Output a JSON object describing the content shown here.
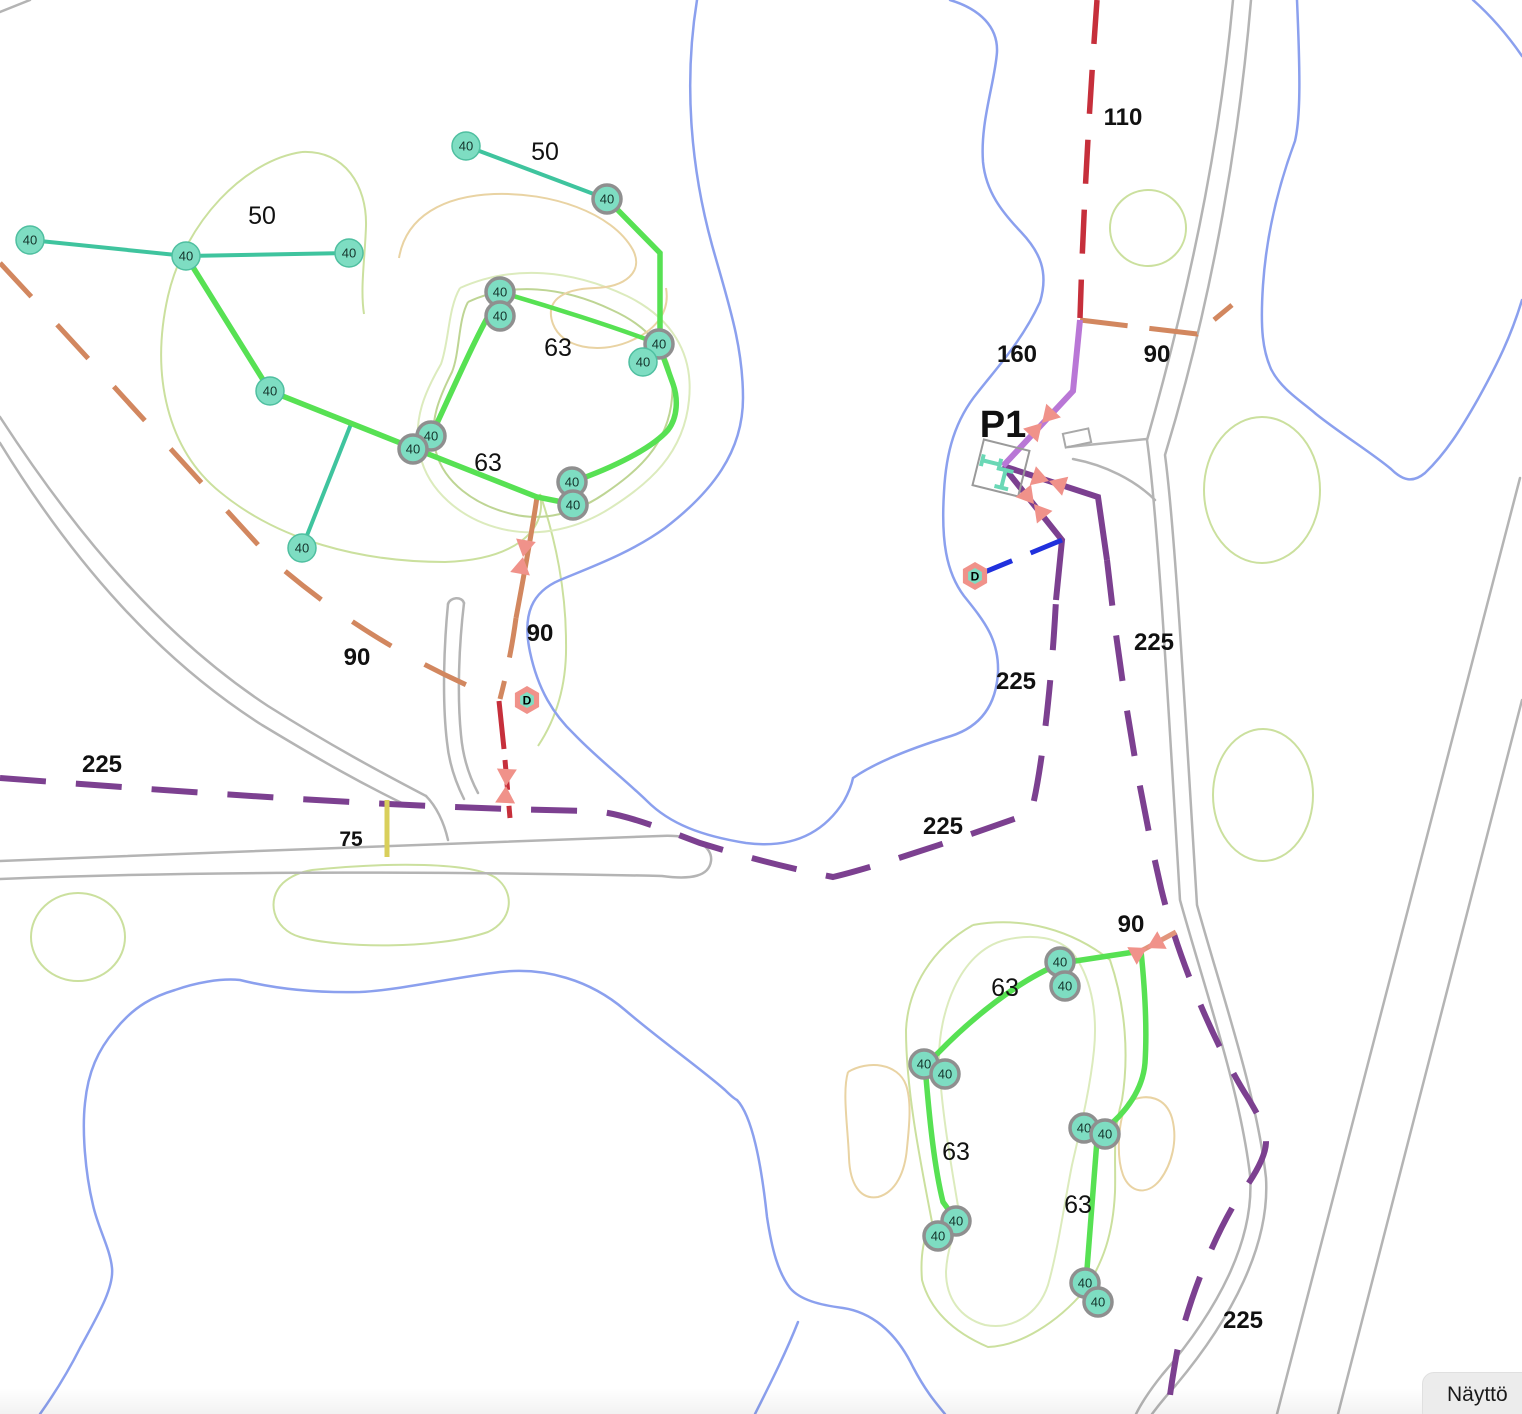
{
  "app": {
    "display_button_label": "Näyttö"
  },
  "map": {
    "width": 1522,
    "height": 1414,
    "node_label": "40",
    "node_radius": 14,
    "colors": {
      "contour_green": "#cbe09e",
      "contour_light": "#dcebbd",
      "contour_olive": "#bed594",
      "contour_tan": "#e9d3a3",
      "water": "#8ba0ee",
      "road": "#b4b4b4",
      "pipe_teal": "#3fc49e",
      "pipe_green": "#57e153",
      "pipe_orange": "#d2875f",
      "pipe_red": "#c62f3b",
      "pipe_purple": "#7c4090",
      "pipe_orchid": "#b977d6",
      "pipe_yellow": "#d9cf5b",
      "pipe_blue": "#2030dd",
      "pipe_salmon": "#e2957c",
      "node_fill": "#7eddc2",
      "node_edge": "#4fbfa0",
      "node_ring": "#8f8f8f",
      "valve": "#f0928a",
      "marker_inner": "#7eddc2",
      "station_outline": "#9a9a9a",
      "station_symbol": "#6ad8b6",
      "building": "#a9a9a9",
      "label": "#111111"
    },
    "contours": [
      {
        "name": "contour-upper-left-outer",
        "color": "contour_green",
        "d": "M302,152 C245,160 185,222 168,296 C150,376 168,450 220,492 C278,540 360,562 445,562 C512,560 548,532 540,494"
      },
      {
        "name": "contour-upper-left-outer-south",
        "color": "contour_green",
        "d": "M540,494 C556,540 566,592 566,642 C567,682 558,716 538,746"
      },
      {
        "name": "contour-upper-left-oval-east",
        "color": "contour_green",
        "d": "M302,152 C345,150 367,186 366,226 C365,258 360,288 364,314"
      },
      {
        "name": "contour-upper-ring-inner",
        "color": "contour_olive",
        "d": "M468,302 C510,282 562,286 612,310 C652,328 676,358 672,398 C668,446 636,472 604,494 C576,513 544,522 512,514 C474,505 444,482 436,452 C428,422 440,396 452,372 C460,352 458,320 468,302"
      },
      {
        "name": "contour-upper-ring-outer",
        "color": "contour_light",
        "d": "M460,288 C514,264 572,270 627,296 C670,317 694,352 689,400 C684,454 648,484 612,507 C580,528 540,538 502,529 C460,519 428,490 420,455 C412,419 426,390 441,364 C449,342 448,308 460,288"
      },
      {
        "name": "contour-upper-tan",
        "color": "contour_tan",
        "d": "M399,258 C406,216 444,196 494,194 C550,192 612,212 633,250 C644,272 625,287 595,288 C560,289 545,302 553,324 C562,348 598,354 628,342 C658,330 670,310 666,288"
      },
      {
        "name": "contour-circle-topright",
        "color": "contour_green",
        "ellipse": [
          1148,
          228,
          38,
          38
        ]
      },
      {
        "name": "contour-oval-east-1",
        "color": "contour_green",
        "ellipse": [
          1262,
          490,
          58,
          73
        ]
      },
      {
        "name": "contour-oval-east-2",
        "color": "contour_green",
        "ellipse": [
          1263,
          795,
          50,
          66
        ]
      },
      {
        "name": "contour-circle-southwest",
        "color": "contour_green",
        "ellipse": [
          78,
          937,
          47,
          44
        ]
      },
      {
        "name": "contour-blob-south",
        "color": "contour_green",
        "d": "M312,870 C390,862 472,862 496,878 C516,893 512,921 488,932 C436,950 338,948 300,937 C272,929 266,899 283,883 C291,876 300,872 312,870"
      },
      {
        "name": "contour-lower-outer",
        "color": "contour_green",
        "d": "M973,925 C1023,916 1072,930 1110,960 C1126,1007 1129,1057 1122,1100 C1112,1135 1116,1160 1115,1192 C1113,1235 1103,1262 1085,1290 C1057,1323 1020,1346 988,1347 C953,1332 930,1310 922,1280 C920,1255 924,1235 932,1222 C920,1160 906,1090 906,1030 C908,988 932,948 973,925"
      },
      {
        "name": "contour-lower-inner",
        "color": "contour_light",
        "d": "M1005,940 C1035,933 1058,938 1072,952 C1090,975 1098,1010 1094,1050 C1090,1090 1080,1130 1072,1165 C1064,1205 1058,1250 1048,1285 C1038,1315 1012,1330 985,1325 C960,1318 946,1298 946,1272 C947,1250 954,1233 960,1218 C952,1170 941,1110 939,1058 C939,1015 958,952 1005,940"
      },
      {
        "name": "contour-tan-lower-left",
        "color": "contour_tan",
        "d": "M848,1072 C868,1060 898,1063 906,1085 C912,1102 909,1128 907,1148 C905,1172 896,1192 878,1197 C860,1200 850,1184 849,1158 C848,1128 842,1092 848,1072"
      },
      {
        "name": "contour-tan-lower-right",
        "color": "contour_tan",
        "d": "M1128,1102 C1148,1092 1166,1098 1172,1118 C1178,1140 1172,1164 1160,1180 C1147,1196 1130,1193 1123,1175 C1116,1156 1118,1118 1128,1102"
      }
    ],
    "water": [
      {
        "name": "water-lake-middle",
        "d": "M697,0 C684,80 690,165 712,245 C728,302 743,345 743,398 C743,452 712,492 665,528 C632,552 594,566 560,580 C532,592 522,614 530,652 C538,690 554,715 574,734 C597,758 622,777 647,801 C670,824 702,836 746,843 C784,848 820,839 844,801 C850,790 852,783 853,778 C876,762 912,748 951,736 C976,728 996,710 998,672 C999,640 985,622 964,596 C946,572 941,540 944,492 C946,452 955,420 978,392 C996,369 1022,341 1040,302 C1049,272 1040,252 1021,232 C1002,212 986,192 983,162 C980,122 995,82 997,52 C998,27 980,9 950,0"
      },
      {
        "name": "water-lake-northeast",
        "d": "M1297,0 C1300,70 1301,115 1295,141 C1282,176 1267,226 1263,285 C1260,330 1263,351 1271,369 C1281,389 1301,401 1316,414 C1341,434 1372,453 1391,469 C1403,481 1413,483 1425,473 C1446,453 1461,429 1478,399 C1498,363 1511,336 1522,300"
      },
      {
        "name": "water-lake-northeast-corner",
        "d": "M1473,0 C1490,15 1506,33 1522,56"
      },
      {
        "name": "water-stream-south",
        "d": "M40,1414 C57,1390 70,1368 80,1348 C98,1315 114,1288 112,1268 C110,1248 98,1228 93,1205 C85,1172 82,1130 85,1103 C88,1072 98,1050 115,1030 C135,1005 155,996 175,990 C195,983 220,978 240,980 C280,990 320,993 360,992 C400,990 450,978 500,972 C545,967 590,980 625,1010 C660,1040 700,1068 725,1090 C733,1098 737,1100 737,1100 C753,1117 762,1170 767,1217 C772,1250 778,1272 790,1288 C800,1300 820,1305 843,1308 C870,1312 895,1330 913,1367 C925,1390 935,1402 945,1414"
      },
      {
        "name": "water-stream-fork",
        "d": "M798,1322 C785,1355 768,1388 755,1414"
      }
    ],
    "roads": [
      {
        "name": "road-ne-left",
        "d": "M1233,0 C1222,120 1198,260 1147,440 C1158,520 1168,700 1180,900 C1205,990 1240,1090 1250,1175 C1255,1240 1218,1310 1162,1375 C1150,1390 1142,1402 1136,1414"
      },
      {
        "name": "road-ne-right",
        "d": "M1251,0 C1240,130 1215,290 1165,455 C1175,530 1185,710 1197,905 C1222,995 1257,1095 1266,1178 C1270,1245 1232,1318 1176,1385 C1166,1396 1158,1406 1152,1414"
      },
      {
        "name": "road-branch-upper",
        "d": "M1068,447 L1147,439"
      },
      {
        "name": "road-branch-lower",
        "d": "M1073,459 C1105,465 1135,480 1155,500"
      },
      {
        "name": "road-west-upper",
        "d": "M0,417 C80,540 165,638 268,706 C330,745 380,772 426,796"
      },
      {
        "name": "road-west-lower",
        "d": "M0,443 C75,565 160,660 262,725 C320,760 360,783 408,806"
      },
      {
        "name": "road-stub-left",
        "d": "M448,604 C444,645 442,700 447,742 C449,763 456,783 464,799"
      },
      {
        "name": "road-stub-right",
        "d": "M464,603 C459,645 457,695 461,735 C463,758 470,778 478,793"
      },
      {
        "name": "road-stub-cap",
        "d": "M448,604 C450,597 462,596 464,603"
      },
      {
        "name": "road-junction-link",
        "d": "M426,796 C436,806 444,822 448,840"
      },
      {
        "name": "road-long-south",
        "d": "M0,861 C220,852 480,843 660,836 C695,834 713,847 711,861 C709,876 692,880 662,876 C480,872 220,870 0,879"
      },
      {
        "name": "road-corner-topleft",
        "d": "M0,12 L30,0"
      },
      {
        "name": "road-se-left",
        "d": "M1520,478 L1277,1414"
      },
      {
        "name": "road-se-right",
        "d": "M1522,700 L1338,1414"
      }
    ],
    "pipes": [
      {
        "name": "pipe-90-west-diagonal",
        "color": "pipe_orange",
        "width": 5,
        "dash": "46 38",
        "d": "M0,263 C95,365 185,465 272,560 C350,628 428,670 499,699"
      },
      {
        "name": "pipe-90-mid-solid",
        "color": "pipe_orange",
        "width": 5,
        "dash": "",
        "d": "M537,497 C531,538 523,580 516,618"
      },
      {
        "name": "pipe-90-mid-dashed",
        "color": "pipe_orange",
        "width": 5,
        "dash": "40 24",
        "d": "M516,618 C512,648 506,676 500,699"
      },
      {
        "name": "pipe-90-east",
        "color": "pipe_orange",
        "width": 5,
        "dash": "48 22",
        "d": "M1080,320 C1112,324 1155,329 1197,334 L1232,305"
      },
      {
        "name": "pipe-110-main",
        "color": "pipe_red",
        "width": 5.5,
        "dash": "44 26",
        "d": "M1097,0 C1089,110 1083,220 1080,318"
      },
      {
        "name": "pipe-red-stub-solid",
        "color": "pipe_red",
        "width": 5,
        "dash": "",
        "d": "M499,701 L504,749"
      },
      {
        "name": "pipe-red-stub-dashed",
        "color": "pipe_red",
        "width": 5,
        "dash": "30 16",
        "d": "M505,760 L510,818"
      },
      {
        "name": "pipe-225-west",
        "color": "pipe_purple",
        "width": 6,
        "dash": "46 30",
        "d": "M0,778 C200,793 400,808 593,811 C620,813 650,824 700,843 C745,857 792,869 833,877 C880,866 978,832 1031,813 C1042,772 1052,678 1056,600"
      },
      {
        "name": "pipe-225-south-solid",
        "color": "pipe_purple",
        "width": 6,
        "dash": "",
        "d": "M1003,466 L1062,540 L1056,600"
      },
      {
        "name": "pipe-225-east-solid",
        "color": "pipe_purple",
        "width": 6,
        "dash": "",
        "d": "M1003,466 L1098,497 L1107,560"
      },
      {
        "name": "pipe-225-east-dashed",
        "color": "pipe_purple",
        "width": 6,
        "dash": "46 30",
        "d": "M1107,560 C1118,660 1135,775 1161,888 C1180,968 1222,1058 1248,1098 C1260,1118 1266,1130 1266,1142 C1266,1156 1254,1177 1238,1198 C1212,1240 1188,1302 1177,1352 C1172,1380 1169,1400 1168,1414"
      },
      {
        "name": "pipe-160-feed",
        "color": "pipe_orchid",
        "width": 6,
        "dash": "",
        "d": "M1003,466 L1073,391 L1080,320"
      },
      {
        "name": "pipe-75-stub",
        "color": "pipe_yellow",
        "width": 5,
        "dash": "",
        "d": "M387,800 L387,857"
      },
      {
        "name": "pipe-outlet-to-d",
        "color": "pipe_blue",
        "width": 5,
        "dash": "34 20",
        "d": "M1062,540 L975,576"
      },
      {
        "name": "pipe-90-connector-south",
        "color": "pipe_salmon",
        "width": 5,
        "dash": "",
        "d": "M1176,932 L1141,951"
      },
      {
        "name": "pipe-50-main",
        "color": "pipe_teal",
        "width": 4,
        "dash": "",
        "d": "M30,240 L186,256 L349,253"
      },
      {
        "name": "pipe-50-north",
        "color": "pipe_teal",
        "width": 4,
        "dash": "",
        "d": "M466,146 L607,199"
      },
      {
        "name": "pipe-50-branch",
        "color": "pipe_teal",
        "width": 4,
        "dash": "",
        "d": "M351,424 L302,548"
      },
      {
        "name": "pipe-63-upper-west",
        "color": "pipe_green",
        "width": 5.5,
        "dash": "",
        "d": "M186,256 L270,391 L413,448 L537,497 L572,504 L572,482"
      },
      {
        "name": "pipe-63-upper-ring-east",
        "color": "pipe_green",
        "width": 5.5,
        "dash": "",
        "d": "M572,482 C615,467 652,448 668,430 C678,417 678,398 673,384 L659,345"
      },
      {
        "name": "pipe-63-upper-feed",
        "color": "pipe_green",
        "width": 5.5,
        "dash": "",
        "d": "M607,199 L660,253 L660,344"
      },
      {
        "name": "pipe-63-upper-ring-top",
        "color": "pipe_green",
        "width": 4.5,
        "dash": "",
        "d": "M500,292 C548,306 615,327 659,344"
      },
      {
        "name": "pipe-63-upper-ring-west",
        "color": "pipe_green",
        "width": 5.5,
        "dash": "",
        "d": "M431,436 C452,392 478,330 500,296"
      },
      {
        "name": "pipe-63-lower-top",
        "color": "pipe_green",
        "width": 5.5,
        "dash": "",
        "d": "M1141,951 L1062,963"
      },
      {
        "name": "pipe-63-lower-west",
        "color": "pipe_green",
        "width": 5.5,
        "dash": "",
        "d": "M1062,963 C1018,980 970,1020 938,1053 L925,1065 C929,1115 934,1166 943,1202 L956,1220"
      },
      {
        "name": "pipe-63-lower-east",
        "color": "pipe_green",
        "width": 5.5,
        "dash": "",
        "d": "M1141,951 C1145,990 1147,1032 1145,1063 C1143,1088 1127,1113 1102,1131"
      },
      {
        "name": "pipe-63-lower-south",
        "color": "pipe_green",
        "width": 5.5,
        "dash": "",
        "d": "M1097,1140 L1086,1282"
      }
    ],
    "valves": [
      {
        "x": 1042,
        "y": 423,
        "angle": -47
      },
      {
        "x": 1049,
        "y": 481,
        "angle": 18
      },
      {
        "x": 1034,
        "y": 504,
        "angle": 51
      },
      {
        "x": 523,
        "y": 557,
        "angle": 100
      },
      {
        "x": 506,
        "y": 786,
        "angle": 93
      },
      {
        "x": 1147,
        "y": 948,
        "angle": 152
      }
    ],
    "d_markers": [
      {
        "x": 527,
        "y": 700,
        "label": "D"
      },
      {
        "x": 975,
        "y": 576,
        "label": "D"
      }
    ],
    "station": {
      "x": 1001,
      "y": 468,
      "size": 47,
      "rotation": 14,
      "label": "P1",
      "symbol_paths": [
        "M-20,-9 L-20,3",
        "M-20,-3 L-2,-3",
        "M-2,-9 L-2,3",
        "M-3,1 L13,1",
        "M5,1 L5,19",
        "M-2,19 L12,19"
      ]
    },
    "building": {
      "x": 1077,
      "y": 438,
      "w": 26,
      "h": 14,
      "rotation": -12
    },
    "nodes": [
      {
        "x": 30,
        "y": 240,
        "ring": false
      },
      {
        "x": 186,
        "y": 256,
        "ring": false
      },
      {
        "x": 349,
        "y": 253,
        "ring": false
      },
      {
        "x": 466,
        "y": 146,
        "ring": false
      },
      {
        "x": 607,
        "y": 199,
        "ring": true
      },
      {
        "x": 500,
        "y": 292,
        "ring": true
      },
      {
        "x": 500,
        "y": 316,
        "ring": true
      },
      {
        "x": 659,
        "y": 344,
        "ring": true
      },
      {
        "x": 643,
        "y": 362,
        "ring": false
      },
      {
        "x": 431,
        "y": 436,
        "ring": true
      },
      {
        "x": 413,
        "y": 449,
        "ring": true
      },
      {
        "x": 270,
        "y": 391,
        "ring": false
      },
      {
        "x": 302,
        "y": 548,
        "ring": false
      },
      {
        "x": 572,
        "y": 482,
        "ring": true
      },
      {
        "x": 573,
        "y": 505,
        "ring": true
      },
      {
        "x": 1060,
        "y": 962,
        "ring": true
      },
      {
        "x": 1065,
        "y": 986,
        "ring": true
      },
      {
        "x": 924,
        "y": 1064,
        "ring": true
      },
      {
        "x": 945,
        "y": 1074,
        "ring": true
      },
      {
        "x": 1084,
        "y": 1128,
        "ring": true
      },
      {
        "x": 1105,
        "y": 1134,
        "ring": true
      },
      {
        "x": 956,
        "y": 1221,
        "ring": true
      },
      {
        "x": 938,
        "y": 1236,
        "ring": true
      },
      {
        "x": 1085,
        "y": 1283,
        "ring": true
      },
      {
        "x": 1098,
        "y": 1302,
        "ring": true
      }
    ],
    "labels": [
      {
        "text": "50",
        "x": 545,
        "y": 160,
        "bold": false,
        "size": 25
      },
      {
        "text": "50",
        "x": 262,
        "y": 224,
        "bold": false,
        "size": 25
      },
      {
        "text": "63",
        "x": 558,
        "y": 356,
        "bold": false,
        "size": 25
      },
      {
        "text": "63",
        "x": 488,
        "y": 471,
        "bold": false,
        "size": 25
      },
      {
        "text": "63",
        "x": 1005,
        "y": 996,
        "bold": false,
        "size": 25
      },
      {
        "text": "63",
        "x": 956,
        "y": 1160,
        "bold": false,
        "size": 25
      },
      {
        "text": "63",
        "x": 1078,
        "y": 1213,
        "bold": false,
        "size": 25
      },
      {
        "text": "110",
        "x": 1123,
        "y": 125,
        "bold": true,
        "size": 24
      },
      {
        "text": "160",
        "x": 1017,
        "y": 362,
        "bold": true,
        "size": 24
      },
      {
        "text": "90",
        "x": 1157,
        "y": 362,
        "bold": true,
        "size": 24
      },
      {
        "text": "90",
        "x": 540,
        "y": 641,
        "bold": true,
        "size": 24
      },
      {
        "text": "90",
        "x": 357,
        "y": 665,
        "bold": true,
        "size": 24
      },
      {
        "text": "90",
        "x": 1131,
        "y": 932,
        "bold": true,
        "size": 24
      },
      {
        "text": "225",
        "x": 102,
        "y": 772,
        "bold": true,
        "size": 24
      },
      {
        "text": "225",
        "x": 1016,
        "y": 689,
        "bold": true,
        "size": 24
      },
      {
        "text": "225",
        "x": 1154,
        "y": 650,
        "bold": true,
        "size": 24
      },
      {
        "text": "225",
        "x": 943,
        "y": 834,
        "bold": true,
        "size": 24
      },
      {
        "text": "225",
        "x": 1243,
        "y": 1328,
        "bold": true,
        "size": 24
      },
      {
        "text": "75",
        "x": 351,
        "y": 846,
        "bold": true,
        "size": 21
      },
      {
        "text": "P1",
        "x": 1003,
        "y": 437,
        "bold": true,
        "size": 38
      }
    ]
  }
}
